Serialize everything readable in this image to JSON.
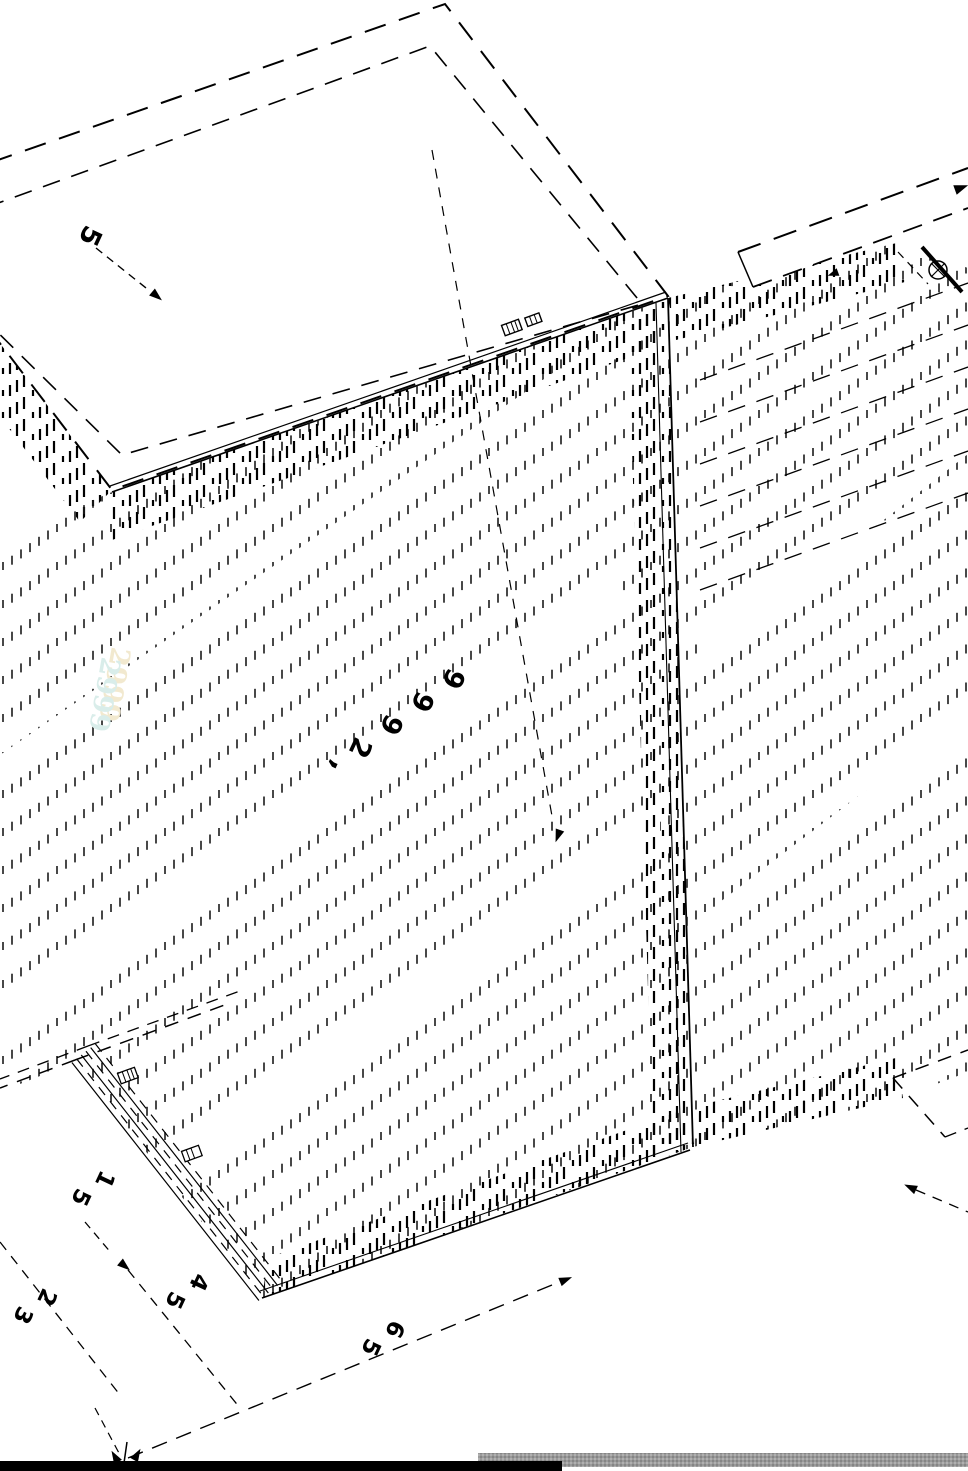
{
  "page": {
    "kind": "technical-drawing",
    "description": "Rotated isometric CAD assembly drawing of panels with phantom dashed outlines, hatched edge bands and dimension annotations",
    "background": "#ffffff",
    "line_color": "#000000"
  },
  "labels": {
    "panel_thickness": {
      "text": "5"
    },
    "dim_main": {
      "text": "2999",
      "mark": ","
    },
    "dim_drawer": {
      "text": "51"
    },
    "dim_a": {
      "text": "32"
    },
    "dim_b": {
      "text": "54"
    },
    "dim_c": {
      "text": "56"
    },
    "watermark": {
      "text": "2999",
      "color_a": "#f2e9cf",
      "color_b": "#d9edea"
    }
  },
  "bottom_bars": {
    "black_bar_color": "#000000",
    "gray_bar_color": "#9a9a9a",
    "gray_bar_alt": "#858585"
  }
}
